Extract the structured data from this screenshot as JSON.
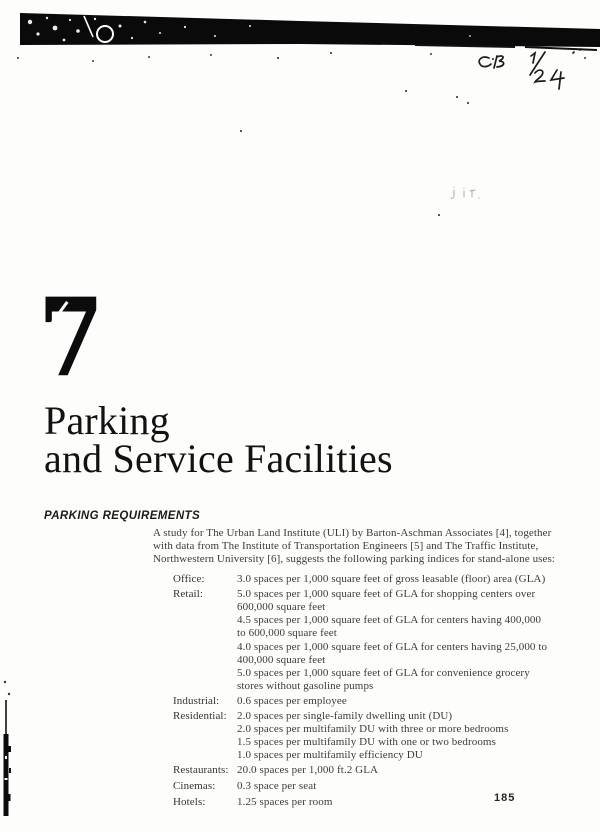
{
  "page": {
    "chapter_number": "7",
    "title_line1": "Parking",
    "title_line2": "and Service Facilities",
    "page_number": "185"
  },
  "handwriting": {
    "note": "CB 1/24"
  },
  "section": {
    "heading": "PARKING REQUIREMENTS",
    "intro_lines": [
      "A study for The Urban Land Institute (ULI) by Barton-Aschman Associates [4], together",
      "with data from The Institute of Transportation Engineers [5] and The Traffic Institute,",
      "Northwestern University [6], suggests the following parking indices for stand-alone uses:"
    ],
    "requirements": {
      "items": [
        {
          "label": "Office:",
          "lines": [
            "3.0 spaces per 1,000 square feet of gross leasable (floor) area (GLA)"
          ]
        },
        {
          "label": "Retail:",
          "lines": [
            "5.0 spaces per 1,000 square feet of GLA for shopping centers over",
            "600,000 square feet",
            "4.5 spaces per 1,000 square feet of GLA for centers having 400,000",
            "to 600,000 square feet",
            "4.0 spaces per 1,000 square feet of GLA for centers having 25,000 to",
            "400,000 square feet",
            "5.0 spaces per 1,000 square feet of GLA for convenience grocery",
            "stores without gasoline pumps"
          ]
        },
        {
          "label": "Industrial:",
          "lines": [
            "0.6 spaces per employee"
          ]
        },
        {
          "label": "Residential:",
          "lines": [
            "2.0 spaces per single-family dwelling unit (DU)",
            "2.0 spaces per multifamily DU with three or more bedrooms",
            "1.5 spaces per multifamily DU with one or two bedrooms",
            "1.0 spaces per multifamily efficiency DU"
          ]
        },
        {
          "label": "Restaurants:",
          "lines": [
            "20.0 spaces per 1,000 ft.2 GLA"
          ]
        },
        {
          "label": "Cinemas:",
          "lines": [
            "0.3 space per seat"
          ]
        },
        {
          "label": "Hotels:",
          "lines": [
            "1.25 spaces per room"
          ]
        }
      ]
    }
  }
}
